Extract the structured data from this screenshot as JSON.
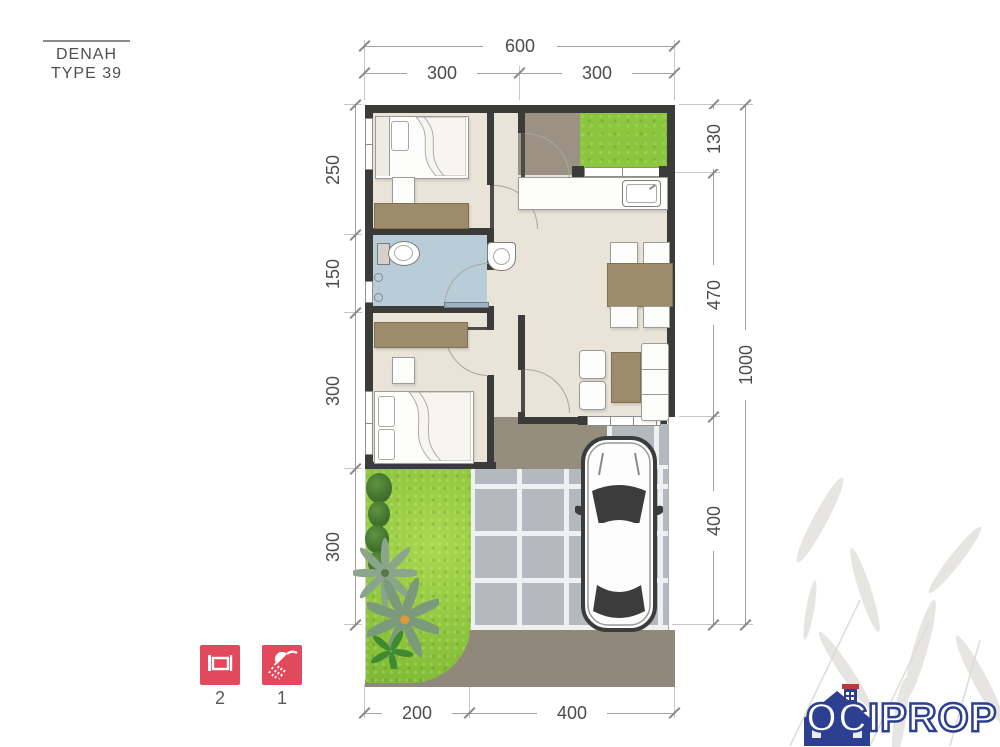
{
  "title": {
    "line1": "DENAH",
    "line2": "TYPE 39"
  },
  "dims": {
    "top_total": "600",
    "top_segments": [
      "300",
      "300"
    ],
    "left": [
      "250",
      "150",
      "300",
      "300"
    ],
    "right_inner": [
      "130",
      "470",
      "400"
    ],
    "right_total": "1000",
    "bottom": [
      "200",
      "400"
    ]
  },
  "legend": {
    "bedroom_count": "2",
    "bathroom_count": "1"
  },
  "logo": {
    "text": "OCIPROP"
  },
  "colors": {
    "wall": "#3b3b39",
    "floor_beige": "#e9e3d8",
    "bath_blue": "#b9cdd9",
    "grass_green": "#8cc63f",
    "paving_gray": "#b4b9bf",
    "street_khaki": "#8f887b",
    "furniture_brown": "#9c8c6c",
    "legend_red": "#e2495d",
    "logo_blue": "#2c3f90"
  }
}
